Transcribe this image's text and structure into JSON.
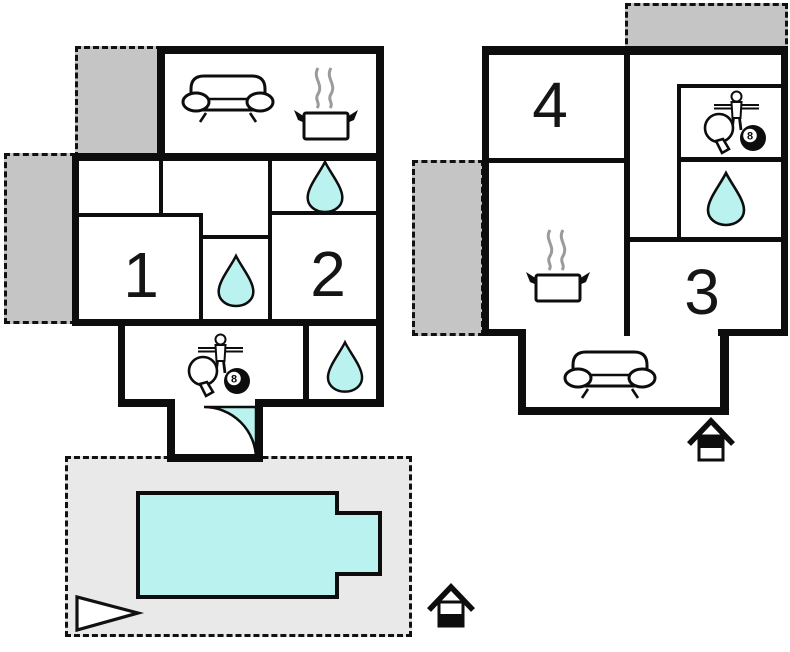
{
  "plan_title": "holiday-house floor plan, two buildings with pool terrace",
  "rooms": {
    "one": "1",
    "two": "2",
    "three": "3",
    "four": "4"
  },
  "ball": {
    "label": "8"
  },
  "colors": {
    "wall": "#0d0d0d",
    "water": "#b9f2ef",
    "annex": "#c5c5c5",
    "terrace": "#e9e9e9",
    "steam": "#9b9b9b",
    "white": "#ffffff"
  },
  "legend_icons": [
    "sofa-icon",
    "cooking-pot-icon",
    "water-drop-icon",
    "game-room-icon",
    "door-swing-icon",
    "pool-shape",
    "direction-triangle-icon",
    "house-logo-icon"
  ]
}
